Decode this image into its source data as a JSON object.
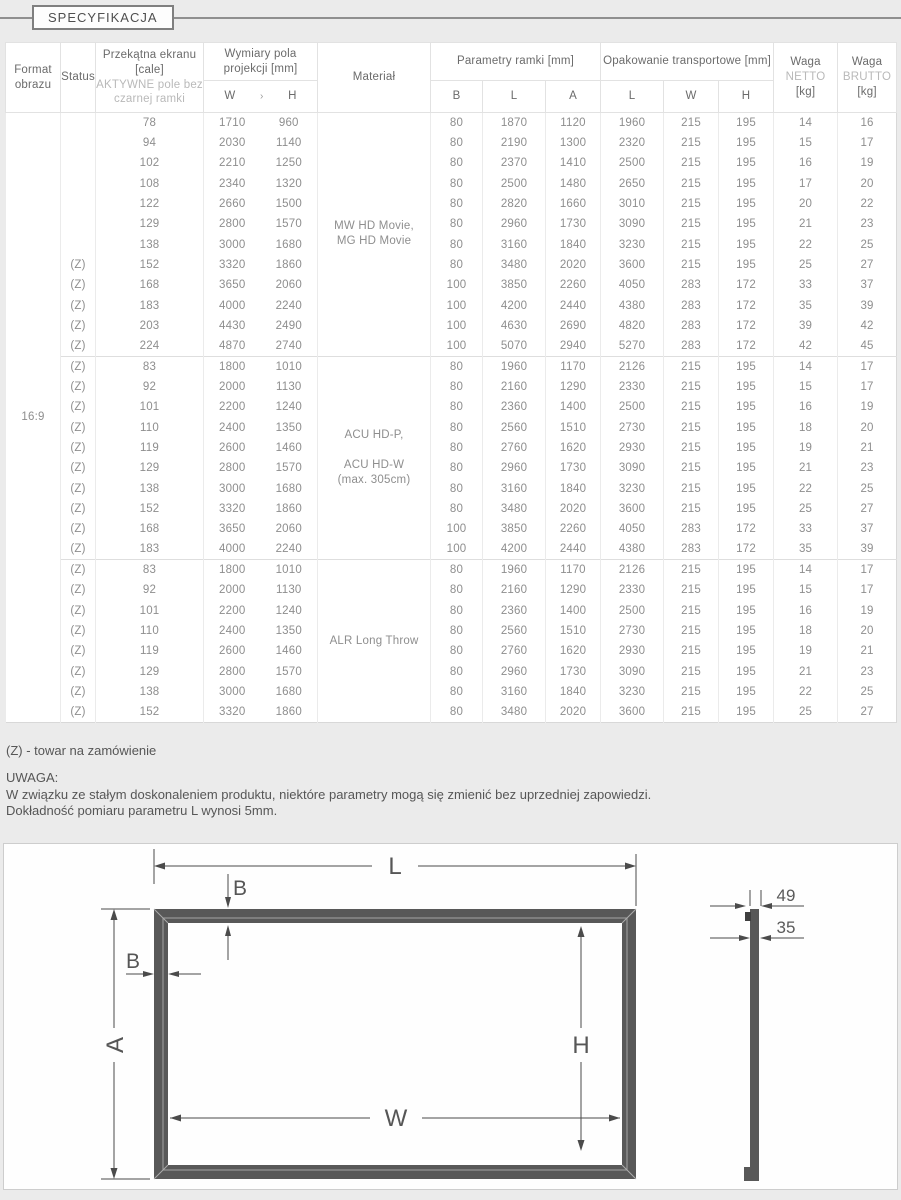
{
  "page": {
    "title_label": "SPECYFIKACJA"
  },
  "table": {
    "headers": {
      "format": "Format obrazu",
      "status": "Status",
      "diagonal_main": "Przekątna ekranu [cale]",
      "diagonal_sub": "AKTYWNE pole bez czarnej ramki",
      "projection": "Wymiary pola projekcji [mm]",
      "projection_w": "W",
      "projection_sep": "›",
      "projection_h": "H",
      "material": "Materiał",
      "frame_params": "Parametry ramki [mm]",
      "frame_sub": [
        "B",
        "L",
        "A"
      ],
      "packaging": "Opakowanie transportowe [mm]",
      "packaging_sub": [
        "L",
        "W",
        "H"
      ],
      "net_line1": "Waga",
      "net_line2": "NETTO",
      "net_line3": "[kg]",
      "gross_line1": "Waga",
      "gross_line2": "BRUTTO",
      "gross_line3": "[kg]"
    },
    "format_value": "16:9",
    "groups": [
      {
        "material": [
          "MW HD Movie,",
          "MG HD Movie"
        ],
        "rows": [
          [
            "",
            "78",
            "1710",
            "960",
            "80",
            "1870",
            "1120",
            "1960",
            "215",
            "195",
            "14",
            "16"
          ],
          [
            "",
            "94",
            "2030",
            "1140",
            "80",
            "2190",
            "1300",
            "2320",
            "215",
            "195",
            "15",
            "17"
          ],
          [
            "",
            "102",
            "2210",
            "1250",
            "80",
            "2370",
            "1410",
            "2500",
            "215",
            "195",
            "16",
            "19"
          ],
          [
            "",
            "108",
            "2340",
            "1320",
            "80",
            "2500",
            "1480",
            "2650",
            "215",
            "195",
            "17",
            "20"
          ],
          [
            "",
            "122",
            "2660",
            "1500",
            "80",
            "2820",
            "1660",
            "3010",
            "215",
            "195",
            "20",
            "22"
          ],
          [
            "",
            "129",
            "2800",
            "1570",
            "80",
            "2960",
            "1730",
            "3090",
            "215",
            "195",
            "21",
            "23"
          ],
          [
            "",
            "138",
            "3000",
            "1680",
            "80",
            "3160",
            "1840",
            "3230",
            "215",
            "195",
            "22",
            "25"
          ],
          [
            "(Z)",
            "152",
            "3320",
            "1860",
            "80",
            "3480",
            "2020",
            "3600",
            "215",
            "195",
            "25",
            "27"
          ],
          [
            "(Z)",
            "168",
            "3650",
            "2060",
            "100",
            "3850",
            "2260",
            "4050",
            "283",
            "172",
            "33",
            "37"
          ],
          [
            "(Z)",
            "183",
            "4000",
            "2240",
            "100",
            "4200",
            "2440",
            "4380",
            "283",
            "172",
            "35",
            "39"
          ],
          [
            "(Z)",
            "203",
            "4430",
            "2490",
            "100",
            "4630",
            "2690",
            "4820",
            "283",
            "172",
            "39",
            "42"
          ],
          [
            "(Z)",
            "224",
            "4870",
            "2740",
            "100",
            "5070",
            "2940",
            "5270",
            "283",
            "172",
            "42",
            "45"
          ]
        ]
      },
      {
        "material": [
          "ACU HD-P,",
          "",
          "ACU HD-W",
          "(max. 305cm)"
        ],
        "rows": [
          [
            "(Z)",
            "83",
            "1800",
            "1010",
            "80",
            "1960",
            "1170",
            "2126",
            "215",
            "195",
            "14",
            "17"
          ],
          [
            "(Z)",
            "92",
            "2000",
            "1130",
            "80",
            "2160",
            "1290",
            "2330",
            "215",
            "195",
            "15",
            "17"
          ],
          [
            "(Z)",
            "101",
            "2200",
            "1240",
            "80",
            "2360",
            "1400",
            "2500",
            "215",
            "195",
            "16",
            "19"
          ],
          [
            "(Z)",
            "110",
            "2400",
            "1350",
            "80",
            "2560",
            "1510",
            "2730",
            "215",
            "195",
            "18",
            "20"
          ],
          [
            "(Z)",
            "119",
            "2600",
            "1460",
            "80",
            "2760",
            "1620",
            "2930",
            "215",
            "195",
            "19",
            "21"
          ],
          [
            "(Z)",
            "129",
            "2800",
            "1570",
            "80",
            "2960",
            "1730",
            "3090",
            "215",
            "195",
            "21",
            "23"
          ],
          [
            "(Z)",
            "138",
            "3000",
            "1680",
            "80",
            "3160",
            "1840",
            "3230",
            "215",
            "195",
            "22",
            "25"
          ],
          [
            "(Z)",
            "152",
            "3320",
            "1860",
            "80",
            "3480",
            "2020",
            "3600",
            "215",
            "195",
            "25",
            "27"
          ],
          [
            "(Z)",
            "168",
            "3650",
            "2060",
            "100",
            "3850",
            "2260",
            "4050",
            "283",
            "172",
            "33",
            "37"
          ],
          [
            "(Z)",
            "183",
            "4000",
            "2240",
            "100",
            "4200",
            "2440",
            "4380",
            "283",
            "172",
            "35",
            "39"
          ]
        ]
      },
      {
        "material": [
          "ALR Long Throw"
        ],
        "rows": [
          [
            "(Z)",
            "83",
            "1800",
            "1010",
            "80",
            "1960",
            "1170",
            "2126",
            "215",
            "195",
            "14",
            "17"
          ],
          [
            "(Z)",
            "92",
            "2000",
            "1130",
            "80",
            "2160",
            "1290",
            "2330",
            "215",
            "195",
            "15",
            "17"
          ],
          [
            "(Z)",
            "101",
            "2200",
            "1240",
            "80",
            "2360",
            "1400",
            "2500",
            "215",
            "195",
            "16",
            "19"
          ],
          [
            "(Z)",
            "110",
            "2400",
            "1350",
            "80",
            "2560",
            "1510",
            "2730",
            "215",
            "195",
            "18",
            "20"
          ],
          [
            "(Z)",
            "119",
            "2600",
            "1460",
            "80",
            "2760",
            "1620",
            "2930",
            "215",
            "195",
            "19",
            "21"
          ],
          [
            "(Z)",
            "129",
            "2800",
            "1570",
            "80",
            "2960",
            "1730",
            "3090",
            "215",
            "195",
            "21",
            "23"
          ],
          [
            "(Z)",
            "138",
            "3000",
            "1680",
            "80",
            "3160",
            "1840",
            "3230",
            "215",
            "195",
            "22",
            "25"
          ],
          [
            "(Z)",
            "152",
            "3320",
            "1860",
            "80",
            "3480",
            "2020",
            "3600",
            "215",
            "195",
            "25",
            "27"
          ]
        ]
      }
    ]
  },
  "footer": {
    "order_note": "(Z) - towar na zamówienie",
    "note_title": "UWAGA:",
    "note_line1": "W związku ze stałym doskonaleniem produktu, niektóre parametry mogą się zmienić bez uprzedniej zapowiedzi.",
    "note_line2": "Dokładność pomiaru parametru L wynosi 5mm."
  },
  "diagram": {
    "labels": {
      "l": "L",
      "b_top": "B",
      "b_left": "B",
      "a": "A",
      "w": "W",
      "h": "H",
      "depth_total": "49",
      "depth_frame": "35"
    },
    "colors": {
      "frame": "#585858",
      "dim_line": "#4b4b4b"
    }
  }
}
